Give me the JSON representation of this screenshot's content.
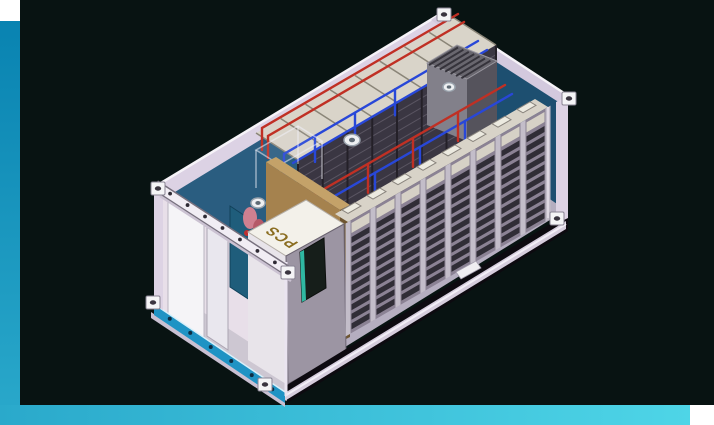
{
  "window": {
    "background": "#081312",
    "corner_square": "#ffffff",
    "accent_bar": {
      "left_top_color": "#0983b1",
      "mid_color": "#2aa9cb",
      "bottom_right_color": "#4ed5e7"
    }
  },
  "scene": {
    "description": "Isometric CAD cutaway render of a containerized battery energy storage system: shipping container with battery rack rows, red and blue coolant piping, rooftop-style HVAC unit, PCS cabinet and utility room",
    "pcs_label": "PCS",
    "colors": {
      "container_shell": "#dcd2e4",
      "container_rail": "#f6f3f8",
      "interior_back_wall": "#2a5d80",
      "interior_end_wall": "#1d4f70",
      "floor": "#b5aec0",
      "rack_face": "#8b8294",
      "rack_slat": "#302d36",
      "rack_post": "#c3bdc9",
      "rack_top": "#d8d3c8",
      "pipe_red": "#c03024",
      "pipe_blue": "#2847d8",
      "hvac_body": "#55535c",
      "partition_brown": "#a5824e",
      "teal_panel": "#1f5d7b",
      "base_skirt_blue": "#1f93c4",
      "pcs_cabinet": "#9c95a3",
      "pcs_text": "#8a6d20"
    },
    "structure": {
      "front_rack_bays": 8,
      "slats_per_bay": 10,
      "back_rack_sections": 8,
      "hvac_grille_slats": 7,
      "rail_bolts": 7,
      "skirt_bolts": 6,
      "circular_fans": 3
    }
  }
}
